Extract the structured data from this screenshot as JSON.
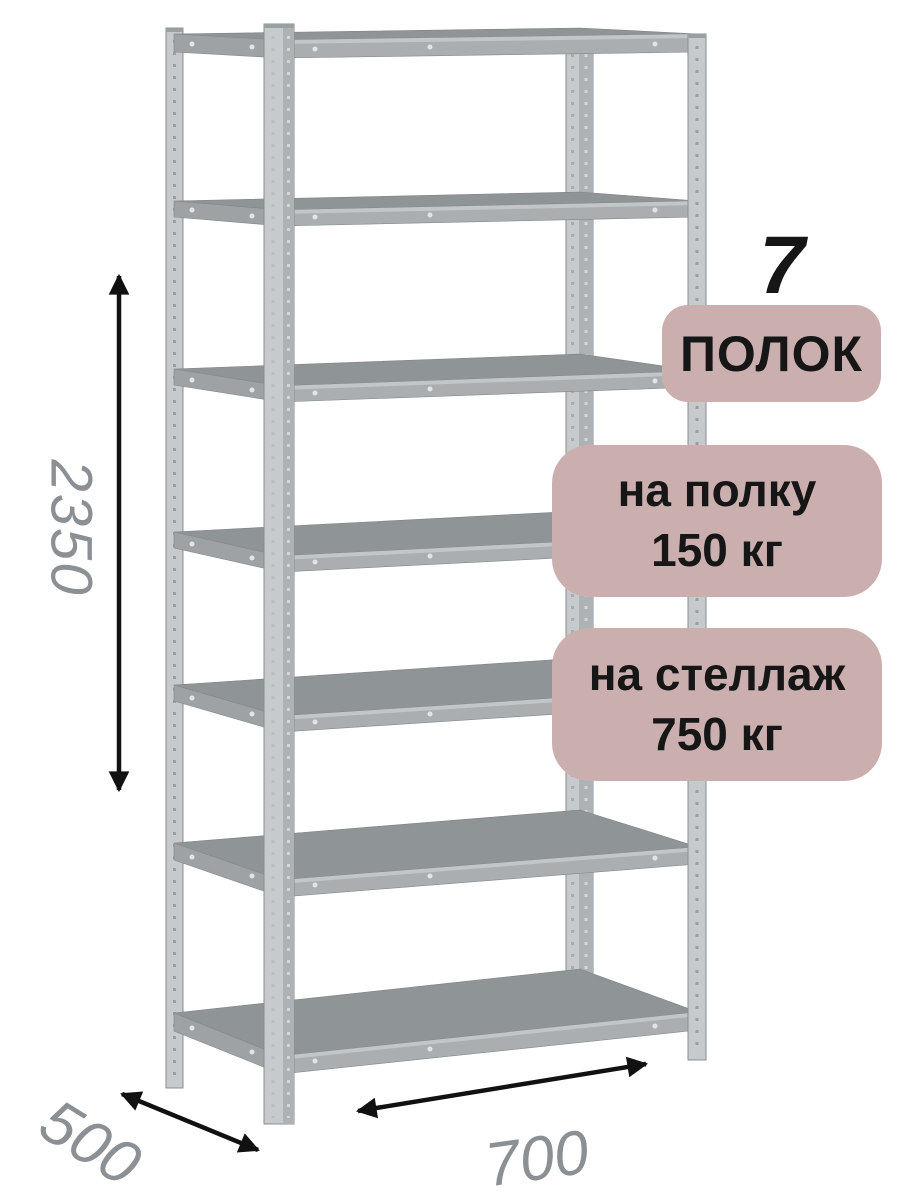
{
  "image": {
    "description": "Metal boltless shelving rack product render with dimension arrows and load badges",
    "background": "#ffffff"
  },
  "annotations": {
    "shelf_count_number": "7",
    "shelf_count_label": "ПОЛОК",
    "shelf_load_line1": "на полку",
    "shelf_load_line2": "150 кг",
    "rack_load_line1": "на стеллаж",
    "rack_load_line2": "750 кг"
  },
  "dimensions": {
    "height": "2350",
    "depth": "500",
    "width": "700"
  },
  "rack": {
    "shelf_count": 7
  },
  "colors": {
    "badge_background": "#cbafaf",
    "badge_text": "#161616",
    "dimension_text": "#8b9094",
    "arrow": "#111111",
    "shelf_surface": "#8f9496",
    "shelf_front_edge": "#aaaeb0",
    "shelf_side_beam": "#9ea2a4",
    "post_light": "#c6cacc",
    "post_dark": "#aeb2b4"
  }
}
